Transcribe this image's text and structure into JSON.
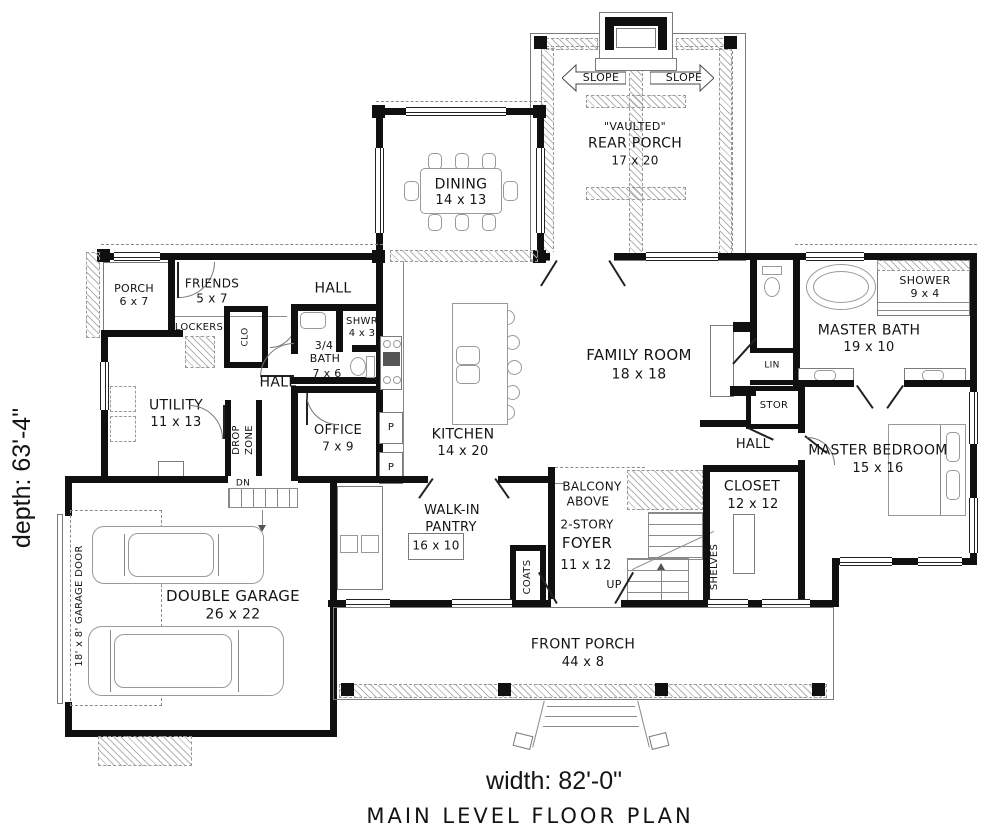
{
  "titles": {
    "plan": "MAIN LEVEL FLOOR PLAN",
    "width": "width: 82'-0\"",
    "depth": "depth: 63'-4\""
  },
  "rooms": {
    "rear_porch": {
      "vaulted": "\"VAULTED\"",
      "name": "REAR PORCH",
      "dims": "17 x 20"
    },
    "slope": {
      "left": "SLOPE",
      "right": "SLOPE"
    },
    "dining": {
      "name": "DINING",
      "dims": "14 x 13"
    },
    "entry_porch": {
      "name": "PORCH",
      "dims": "6 x 7"
    },
    "friends": {
      "name": "FRIENDS",
      "dims": "5 x 7"
    },
    "lockers": {
      "name": "LOCKERS"
    },
    "clo": {
      "name": "CLO"
    },
    "hall_upper": {
      "name": "HALL"
    },
    "hall_mid": {
      "name": "HALL"
    },
    "hall_master": {
      "name": "HALL"
    },
    "shwr": {
      "name": "SHWR",
      "dims": "4 x 3"
    },
    "three_quarter_bath": {
      "line1": "3/4",
      "line2": "BATH",
      "dims": "7 x 6"
    },
    "utility": {
      "name": "UTILITY",
      "dims": "11 x 13"
    },
    "drop_zone": {
      "line1": "DROP",
      "line2": "ZONE"
    },
    "dn": {
      "name": "DN"
    },
    "office": {
      "name": "OFFICE",
      "dims": "7 x 9"
    },
    "kitchen": {
      "name": "KITCHEN",
      "dims": "14 x 20"
    },
    "pantry_pullouts": {
      "p1": "P",
      "p2": "P"
    },
    "family_room": {
      "name": "FAMILY ROOM",
      "dims": "18 x 18"
    },
    "lin": {
      "name": "LIN"
    },
    "stor": {
      "name": "STOR"
    },
    "master_bath": {
      "name": "MASTER BATH",
      "dims": "19 x 10"
    },
    "shower": {
      "name": "SHOWER",
      "dims": "9 x 4"
    },
    "master_bedroom": {
      "name": "MASTER BEDROOM",
      "dims": "15 x 16"
    },
    "balcony": {
      "line1": "BALCONY",
      "line2": "ABOVE"
    },
    "foyer": {
      "line1": "2-STORY",
      "line2": "FOYER",
      "dims": "11 x 12"
    },
    "up": {
      "name": "UP"
    },
    "coats": {
      "name": "COATS"
    },
    "shelves": {
      "name": "SHELVES"
    },
    "closet": {
      "name": "CLOSET",
      "dims": "12 x 12"
    },
    "walk_in_pantry": {
      "line1": "WALK-IN",
      "line2": "PANTRY",
      "dims": "16 x 10"
    },
    "garage": {
      "name": "DOUBLE GARAGE",
      "dims": "26 x 22"
    },
    "garage_door": {
      "name": "18' x 8' GARAGE DOOR"
    },
    "front_porch": {
      "name": "FRONT PORCH",
      "dims": "44 x 8"
    }
  }
}
